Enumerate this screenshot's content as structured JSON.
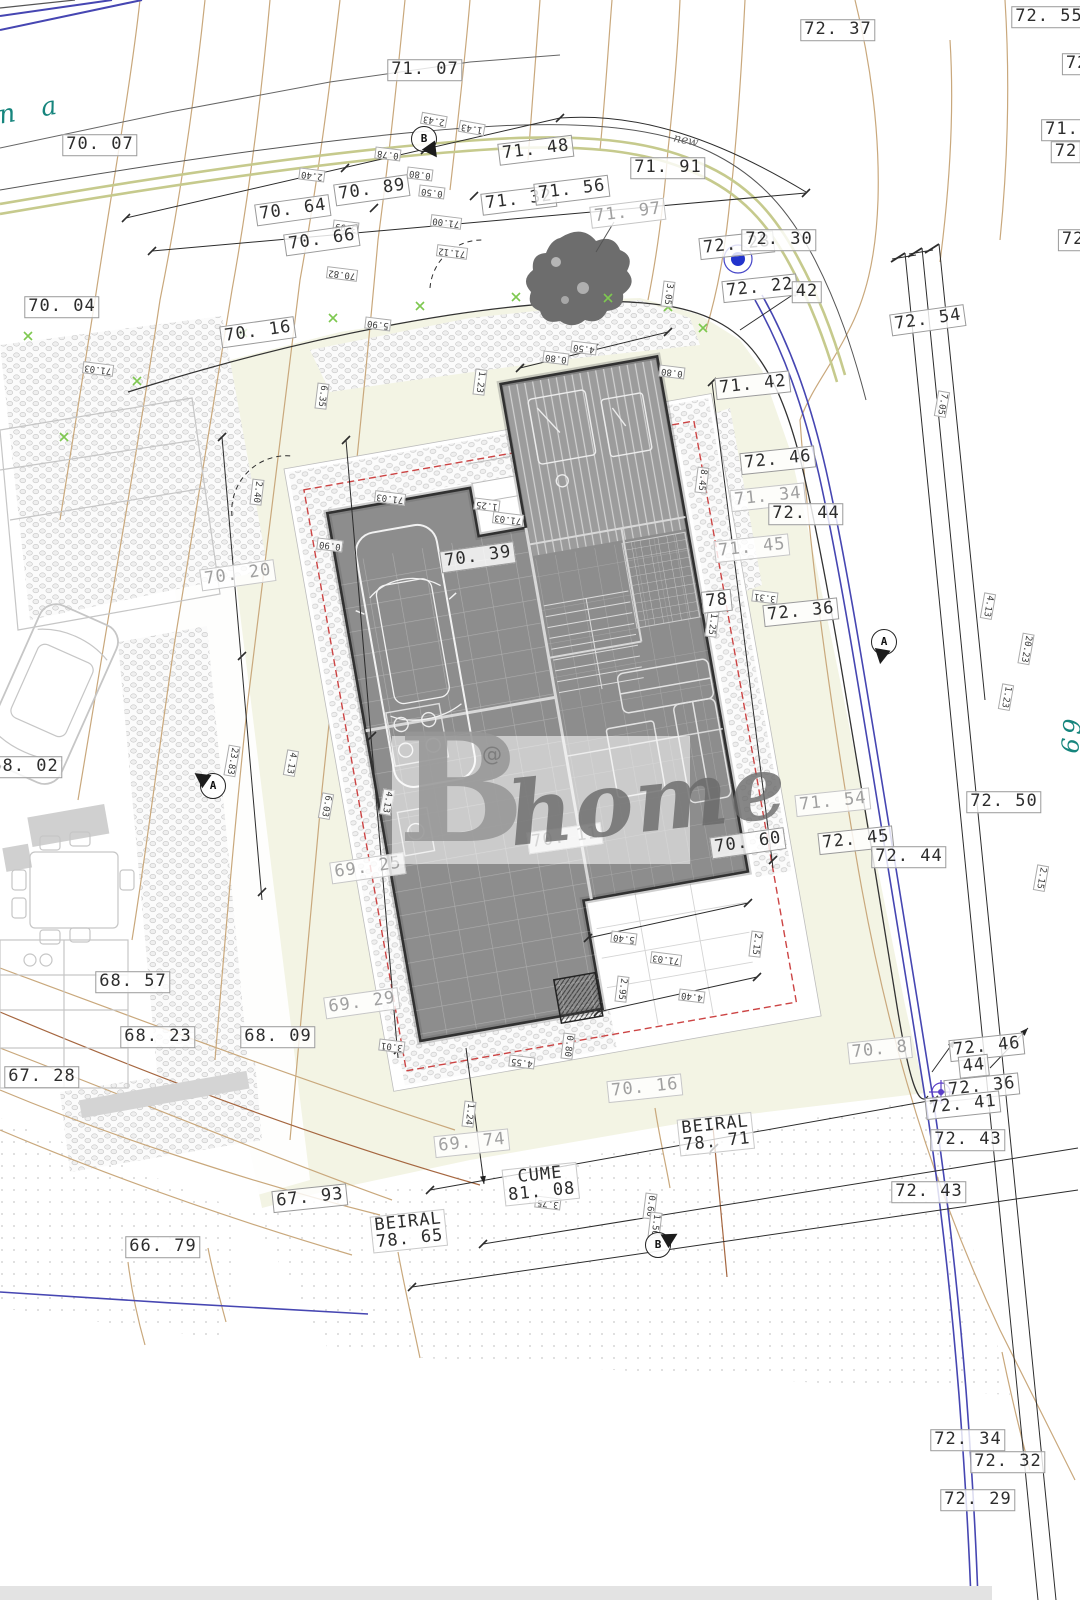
{
  "plan": {
    "watermark": {
      "letter": "B",
      "word": "home",
      "at": "@"
    },
    "street_text_fragment": "n a",
    "street_side_fragment": "69",
    "handwritten_note": "new",
    "colors": {
      "contour": "#c9a87c",
      "contour_dark": "#a5663f",
      "boundary_blue": "#4646b2",
      "setback_red": "#cc4444",
      "lot_fill": "#f3f4e4",
      "building_fill": "#8d8d8d",
      "road_olive": "#c6ca8d",
      "teal": "#16857d",
      "green_mark": "#7ec850"
    },
    "elevation_labels": [
      {
        "t": "72. 37",
        "x": 838,
        "y": 30,
        "r": 0,
        "s": "k"
      },
      {
        "t": "71. 07",
        "x": 425,
        "y": 70,
        "r": 0,
        "s": "k"
      },
      {
        "t": "70. 07",
        "x": 100,
        "y": 145,
        "r": 0,
        "s": "k"
      },
      {
        "t": "71. 48",
        "x": 536,
        "y": 150,
        "r": -7,
        "s": "k"
      },
      {
        "t": "71. 91",
        "x": 668,
        "y": 168,
        "r": 0,
        "s": "k"
      },
      {
        "t": "70. 89",
        "x": 372,
        "y": 190,
        "r": -8,
        "s": "k"
      },
      {
        "t": "70. 64",
        "x": 293,
        "y": 210,
        "r": -8,
        "s": "k"
      },
      {
        "t": "71. 32",
        "x": 519,
        "y": 200,
        "r": -7,
        "s": "k"
      },
      {
        "t": "71. 56",
        "x": 572,
        "y": 190,
        "r": -7,
        "s": "k"
      },
      {
        "t": "71. 97",
        "x": 628,
        "y": 213,
        "r": -7,
        "s": "g"
      },
      {
        "t": "70. 66",
        "x": 322,
        "y": 240,
        "r": -8,
        "s": "k"
      },
      {
        "t": "72. 28",
        "x": 737,
        "y": 245,
        "r": -6,
        "s": "k"
      },
      {
        "t": "72. 30",
        "x": 779,
        "y": 240,
        "r": 0,
        "s": "k"
      },
      {
        "t": "72. 22",
        "x": 760,
        "y": 288,
        "r": -6,
        "s": "k"
      },
      {
        "t": "42",
        "x": 807,
        "y": 292,
        "r": 0,
        "s": "k"
      },
      {
        "t": "70. 04",
        "x": 62,
        "y": 307,
        "r": 0,
        "s": "k"
      },
      {
        "t": "72. 54",
        "x": 928,
        "y": 320,
        "r": -8,
        "s": "k"
      },
      {
        "t": "70. 16",
        "x": 258,
        "y": 332,
        "r": -8,
        "s": "k"
      },
      {
        "t": "71. 42",
        "x": 753,
        "y": 385,
        "r": -6,
        "s": "k"
      },
      {
        "t": "72. 46",
        "x": 778,
        "y": 460,
        "r": -6,
        "s": "k"
      },
      {
        "t": "71. 34",
        "x": 768,
        "y": 497,
        "r": -6,
        "s": "g"
      },
      {
        "t": "72. 44",
        "x": 806,
        "y": 514,
        "r": 0,
        "s": "k"
      },
      {
        "t": "71. 45",
        "x": 752,
        "y": 548,
        "r": -6,
        "s": "g"
      },
      {
        "t": "70. 20",
        "x": 238,
        "y": 575,
        "r": -8,
        "s": "g"
      },
      {
        "t": "70. 39",
        "x": 478,
        "y": 557,
        "r": -8,
        "s": "k"
      },
      {
        "t": "78",
        "x": 717,
        "y": 601,
        "r": -6,
        "s": "k"
      },
      {
        "t": "72. 36",
        "x": 801,
        "y": 612,
        "r": -6,
        "s": "k"
      },
      {
        "t": "68. 02",
        "x": 25,
        "y": 767,
        "r": 0,
        "s": "k"
      },
      {
        "t": "71. 54",
        "x": 833,
        "y": 802,
        "r": -6,
        "s": "g"
      },
      {
        "t": "72. 50",
        "x": 1004,
        "y": 802,
        "r": 0,
        "s": "k"
      },
      {
        "t": "72. 45",
        "x": 856,
        "y": 840,
        "r": -6,
        "s": "k"
      },
      {
        "t": "72. 44",
        "x": 909,
        "y": 857,
        "r": 0,
        "s": "k"
      },
      {
        "t": "70. 60",
        "x": 748,
        "y": 843,
        "r": -8,
        "s": "k"
      },
      {
        "t": "70. 11",
        "x": 565,
        "y": 838,
        "r": -8,
        "s": "g"
      },
      {
        "t": "69. 25",
        "x": 368,
        "y": 868,
        "r": -8,
        "s": "g"
      },
      {
        "t": "68. 57",
        "x": 133,
        "y": 982,
        "r": 0,
        "s": "k"
      },
      {
        "t": "69. 29",
        "x": 362,
        "y": 1003,
        "r": -8,
        "s": "g"
      },
      {
        "t": "68. 23",
        "x": 158,
        "y": 1037,
        "r": 0,
        "s": "k"
      },
      {
        "t": "68. 09",
        "x": 278,
        "y": 1037,
        "r": 0,
        "s": "k"
      },
      {
        "t": "67. 28",
        "x": 42,
        "y": 1077,
        "r": 0,
        "s": "k"
      },
      {
        "t": "70. 8",
        "x": 880,
        "y": 1050,
        "r": -6,
        "s": "g"
      },
      {
        "t": "72. 46",
        "x": 987,
        "y": 1047,
        "r": -6,
        "s": "k"
      },
      {
        "t": "44",
        "x": 974,
        "y": 1066,
        "r": -6,
        "s": "k"
      },
      {
        "t": "72. 36",
        "x": 982,
        "y": 1087,
        "r": -6,
        "s": "k"
      },
      {
        "t": "72. 41",
        "x": 963,
        "y": 1105,
        "r": -6,
        "s": "k"
      },
      {
        "t": "70. 16",
        "x": 645,
        "y": 1088,
        "r": -6,
        "s": "g"
      },
      {
        "t": "69. 74",
        "x": 472,
        "y": 1143,
        "r": -6,
        "s": "g"
      },
      {
        "t": "72. 43",
        "x": 968,
        "y": 1140,
        "r": 0,
        "s": "k"
      },
      {
        "t": "72. 43",
        "x": 929,
        "y": 1192,
        "r": 0,
        "s": "k"
      },
      {
        "t": "67. 93",
        "x": 310,
        "y": 1198,
        "r": -6,
        "s": "k"
      },
      {
        "t": "66. 79",
        "x": 163,
        "y": 1247,
        "r": 0,
        "s": "k"
      },
      {
        "t": "72. 34",
        "x": 968,
        "y": 1440,
        "r": 0,
        "s": "k"
      },
      {
        "t": "72. 32",
        "x": 1008,
        "y": 1462,
        "r": 0,
        "s": "k"
      },
      {
        "t": "72. 29",
        "x": 978,
        "y": 1500,
        "r": 0,
        "s": "k"
      },
      {
        "t": "72. 55",
        "x": 1049,
        "y": 17,
        "r": 0,
        "s": "k"
      },
      {
        "t": "72. 4",
        "x": 1094,
        "y": 64,
        "r": 0,
        "s": "k"
      },
      {
        "t": "71.",
        "x": 1062,
        "y": 130,
        "r": 0,
        "s": "k"
      },
      {
        "t": "72",
        "x": 1066,
        "y": 152,
        "r": 0,
        "s": "k"
      },
      {
        "t": "72. 3",
        "x": 1090,
        "y": 240,
        "r": 0,
        "s": "k"
      },
      {
        "t": "BEIRAL",
        "l2": "78. 71",
        "x": 716,
        "y": 1134,
        "r": -6,
        "s": "p"
      },
      {
        "t": "CUME",
        "l2": "81. 08",
        "x": 541,
        "y": 1184,
        "r": -6,
        "s": "p"
      },
      {
        "t": "BEIRAL",
        "l2": "78. 65",
        "x": 409,
        "y": 1231,
        "r": -6,
        "s": "p"
      }
    ],
    "dim_labels": [
      {
        "t": "3.99",
        "x": 346,
        "y": 227,
        "r": 187
      },
      {
        "t": "2.40",
        "x": 312,
        "y": 175,
        "r": 187
      },
      {
        "t": "0.78",
        "x": 388,
        "y": 154,
        "r": 187
      },
      {
        "t": "2.43",
        "x": 434,
        "y": 120,
        "r": 190
      },
      {
        "t": "1.43",
        "x": 472,
        "y": 128,
        "r": 190
      },
      {
        "t": "0.80",
        "x": 420,
        "y": 174,
        "r": 187
      },
      {
        "t": "0.50",
        "x": 432,
        "y": 192,
        "r": 187
      },
      {
        "t": "71.00",
        "x": 446,
        "y": 222,
        "r": 187
      },
      {
        "t": "71.12",
        "x": 452,
        "y": 252,
        "r": 187
      },
      {
        "t": "70.82",
        "x": 342,
        "y": 274,
        "r": 187
      },
      {
        "t": "4.50",
        "x": 584,
        "y": 348,
        "r": 187
      },
      {
        "t": "0.80",
        "x": 556,
        "y": 358,
        "r": 187
      },
      {
        "t": "0.80",
        "x": 672,
        "y": 372,
        "r": 187
      },
      {
        "t": "1.23",
        "x": 480,
        "y": 382,
        "r": 97
      },
      {
        "t": "8.45",
        "x": 702,
        "y": 480,
        "r": 97
      },
      {
        "t": "6.35",
        "x": 322,
        "y": 396,
        "r": 97
      },
      {
        "t": "5.90",
        "x": 378,
        "y": 324,
        "r": 187
      },
      {
        "t": "71.03",
        "x": 98,
        "y": 369,
        "r": 187
      },
      {
        "t": "71.03",
        "x": 390,
        "y": 498,
        "r": 187
      },
      {
        "t": "71.03",
        "x": 508,
        "y": 519,
        "r": 187
      },
      {
        "t": "1.25",
        "x": 487,
        "y": 505,
        "r": 187
      },
      {
        "t": "2.40",
        "x": 257,
        "y": 492,
        "r": 97
      },
      {
        "t": "0.90",
        "x": 330,
        "y": 545,
        "r": 187
      },
      {
        "t": "3.05",
        "x": 668,
        "y": 294,
        "r": 97
      },
      {
        "t": "1.25",
        "x": 712,
        "y": 624,
        "r": 97
      },
      {
        "t": "3.31",
        "x": 765,
        "y": 597,
        "r": 187
      },
      {
        "t": "5.40",
        "x": 624,
        "y": 938,
        "r": 187
      },
      {
        "t": "2.15",
        "x": 756,
        "y": 944,
        "r": 97
      },
      {
        "t": "71.03",
        "x": 666,
        "y": 959,
        "r": 187
      },
      {
        "t": "2.95",
        "x": 622,
        "y": 989,
        "r": 97
      },
      {
        "t": "4.40",
        "x": 692,
        "y": 996,
        "r": 187
      },
      {
        "t": "0.80",
        "x": 568,
        "y": 1046,
        "r": 97
      },
      {
        "t": "4.55",
        "x": 522,
        "y": 1062,
        "r": 187
      },
      {
        "t": "3.01",
        "x": 392,
        "y": 1046,
        "r": 187
      },
      {
        "t": "3.75",
        "x": 548,
        "y": 1203,
        "r": 187
      },
      {
        "t": "0.60",
        "x": 650,
        "y": 1206,
        "r": 97
      },
      {
        "t": "1.50",
        "x": 655,
        "y": 1225,
        "r": 97
      },
      {
        "t": "1.24",
        "x": 469,
        "y": 1114,
        "r": 97
      },
      {
        "t": "7.05",
        "x": 942,
        "y": 404,
        "r": 100
      },
      {
        "t": "4.13",
        "x": 988,
        "y": 606,
        "r": 100
      },
      {
        "t": "20.23",
        "x": 1026,
        "y": 649,
        "r": 100
      },
      {
        "t": "1.23",
        "x": 1006,
        "y": 697,
        "r": 100
      },
      {
        "t": "2.15",
        "x": 1041,
        "y": 878,
        "r": 100
      },
      {
        "t": "23.83",
        "x": 232,
        "y": 761,
        "r": 100
      },
      {
        "t": "4.13",
        "x": 291,
        "y": 763,
        "r": 100
      },
      {
        "t": "6.03",
        "x": 326,
        "y": 806,
        "r": 100
      },
      {
        "t": "4.13",
        "x": 387,
        "y": 802,
        "r": 100
      }
    ],
    "section_markers": [
      {
        "letter": "B",
        "x": 424,
        "y": 139,
        "r": -125
      },
      {
        "letter": "A",
        "x": 213,
        "y": 786,
        "r": 35
      },
      {
        "letter": "A",
        "x": 884,
        "y": 642,
        "r": -80
      },
      {
        "letter": "B",
        "x": 658,
        "y": 1245,
        "r": 150
      }
    ]
  }
}
